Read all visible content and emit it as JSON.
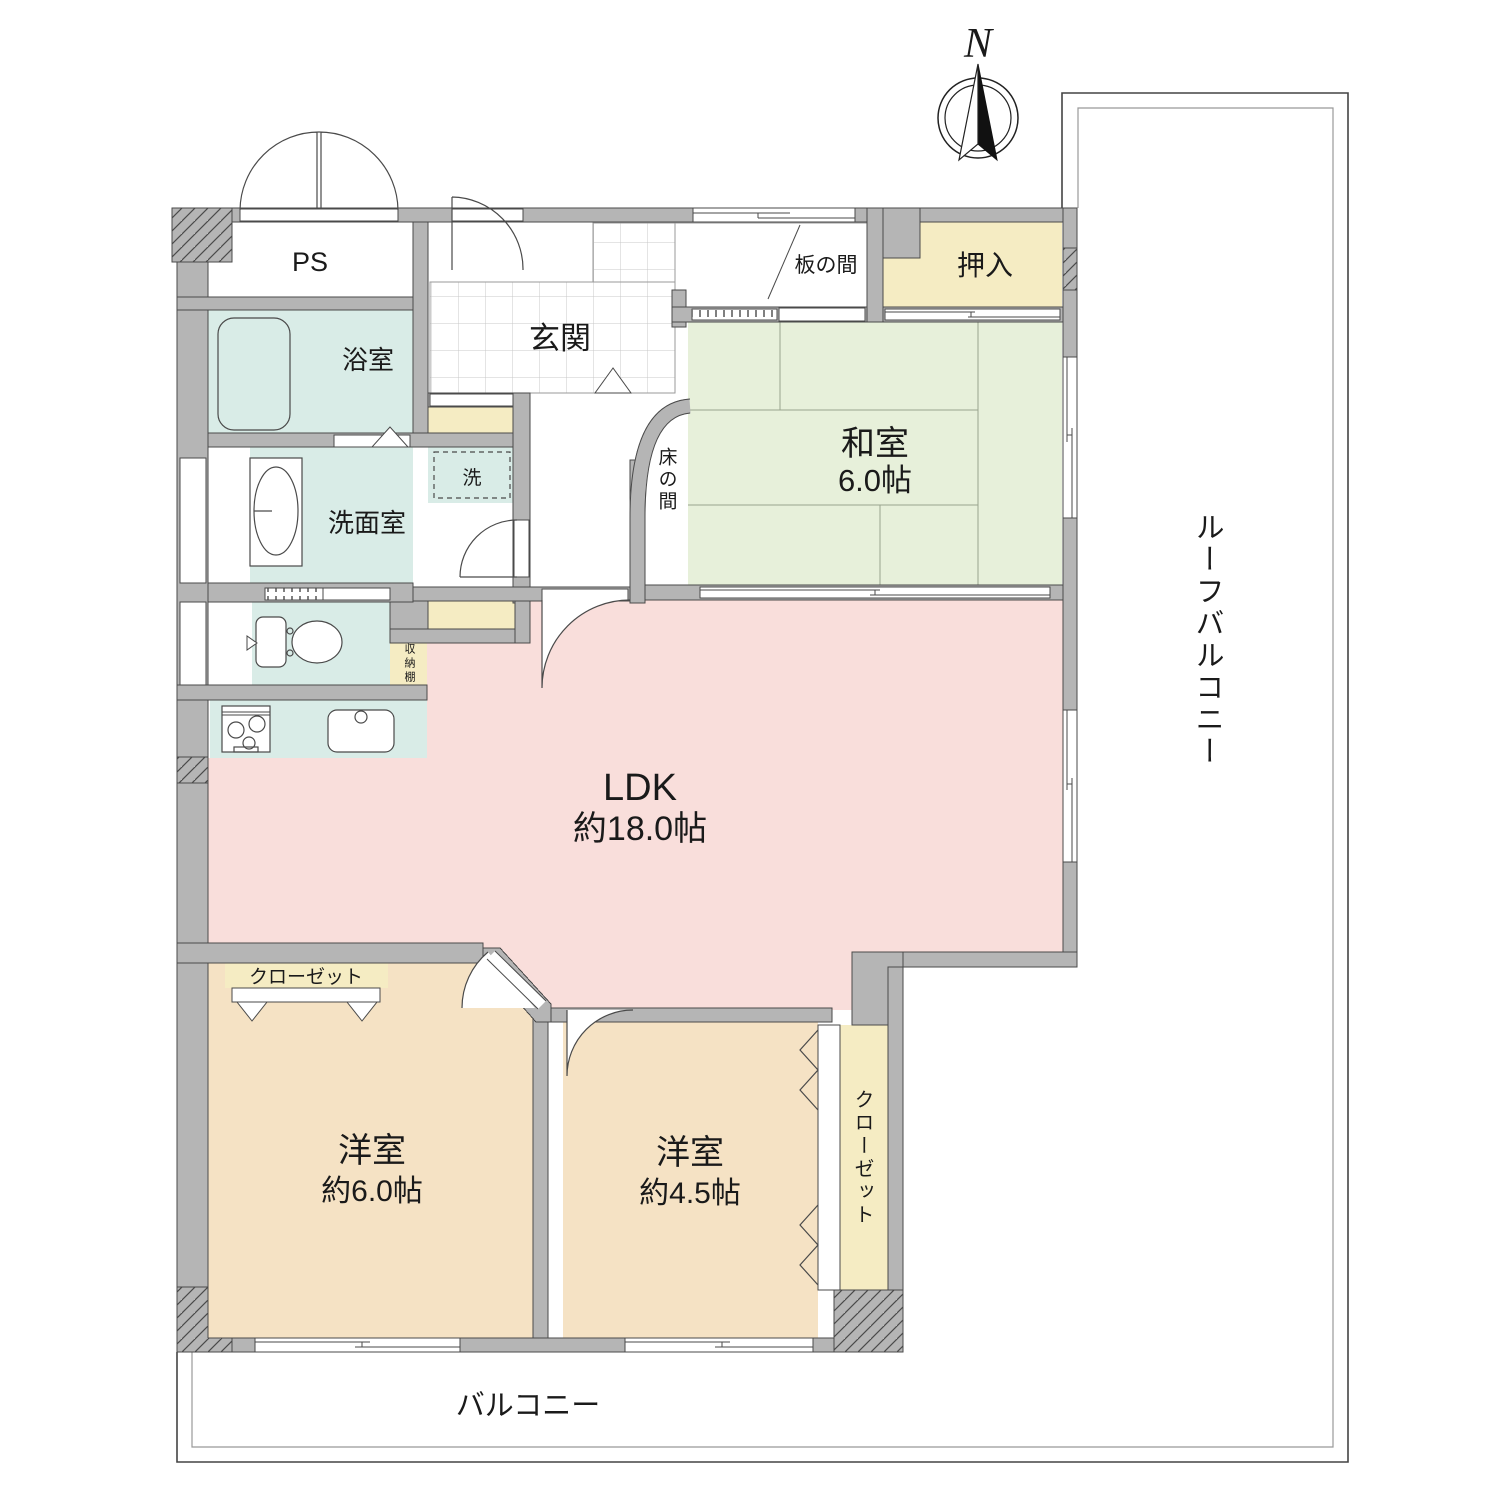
{
  "floor_plan": {
    "compass": {
      "north_label": "N"
    },
    "rooms": {
      "ps": {
        "label": "PS"
      },
      "bathroom": {
        "label": "浴室"
      },
      "washroom": {
        "label": "洗面室"
      },
      "washer": {
        "label": "洗"
      },
      "entrance": {
        "label": "玄関"
      },
      "itanoma": {
        "label": "板の間"
      },
      "oshiire": {
        "label": "押入"
      },
      "washitsu": {
        "label": "和室",
        "size": "6.0帖"
      },
      "tokonoma": {
        "label": "床の間"
      },
      "storage_shelf": {
        "label": "収納棚"
      },
      "ldk": {
        "label": "LDK",
        "size": "約18.0帖"
      },
      "western_room_1": {
        "label": "洋室",
        "size": "約6.0帖"
      },
      "western_room_2": {
        "label": "洋室",
        "size": "約4.5帖"
      },
      "closet_1": {
        "label": "クローゼット"
      },
      "closet_2": {
        "label": "クローゼット"
      },
      "balcony": {
        "label": "バルコニー"
      },
      "roof_balcony": {
        "label": "ルーフバルコニー"
      }
    },
    "colors": {
      "wall": "#b5b5b5",
      "outline": "#4a4a4a",
      "tatami_room": "#e7f0da",
      "ldk": "#f9dedb",
      "western_room": "#f5e2c4",
      "wet_area": "#d9ece7",
      "storage": "#f5ecc3",
      "tile_line": "#c9c9c9"
    }
  }
}
